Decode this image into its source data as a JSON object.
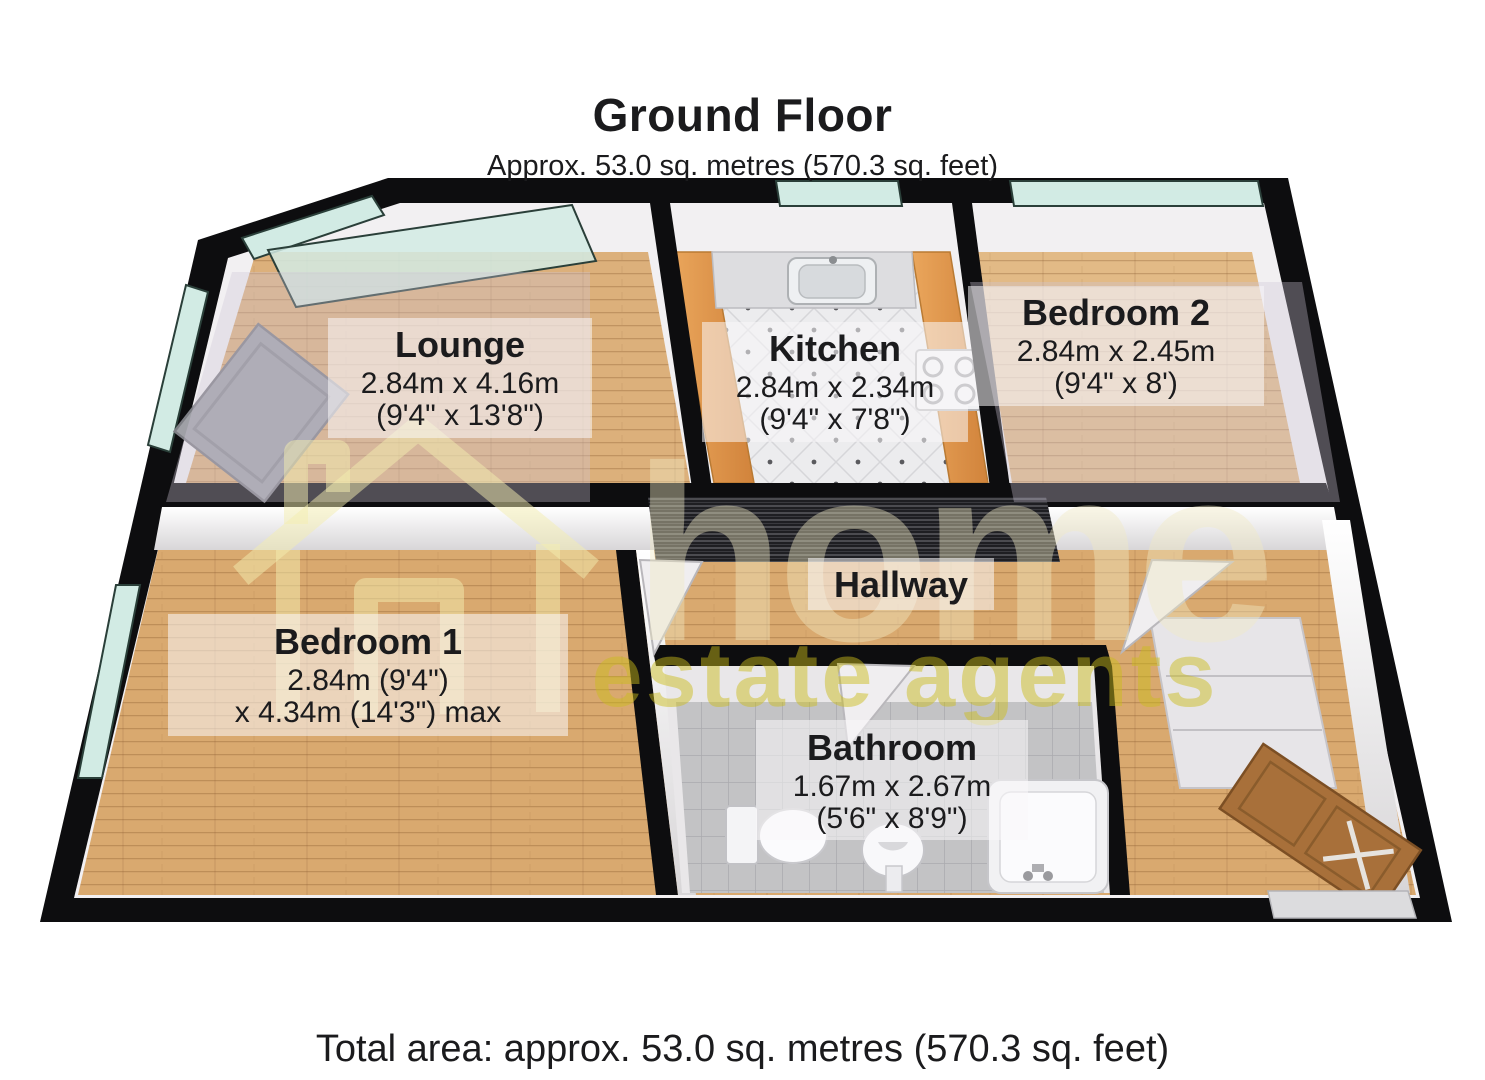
{
  "header": {
    "title": "Ground Floor",
    "subtitle": "Approx. 53.0 sq. metres (570.3 sq. feet)"
  },
  "footer": {
    "total_area": "Total area: approx. 53.0 sq. metres (570.3 sq. feet)"
  },
  "watermark": {
    "brand_line1": "home",
    "brand_line2": "estate agents",
    "icon": "house-outline-icon",
    "yellow": "#c9b71e"
  },
  "rooms": {
    "lounge": {
      "name": "Lounge",
      "metric": "2.84m x 4.16m",
      "imperial": "(9'4\" x 13'8\")"
    },
    "kitchen": {
      "name": "Kitchen",
      "metric": "2.84m x 2.34m",
      "imperial": "(9'4\" x 7'8\")"
    },
    "bedroom2": {
      "name": "Bedroom 2",
      "metric": "2.84m x 2.45m",
      "imperial": "(9'4\" x 8')"
    },
    "hallway": {
      "name": "Hallway"
    },
    "bedroom1": {
      "name": "Bedroom 1",
      "metric": "2.84m (9'4\")",
      "imperial": "x 4.34m (14'3\") max"
    },
    "bathroom": {
      "name": "Bathroom",
      "metric": "1.67m x 2.67m",
      "imperial": "(5'6\" x 8'9\")"
    }
  },
  "colors": {
    "wall": "#0d0d0f",
    "wood": "#dcae76",
    "glass": "#d2ebe4",
    "counter": "#df9a50",
    "tile_kitchen": "#ececee",
    "tile_bath": "#c3c3c5",
    "front_door": "#a8703a"
  }
}
